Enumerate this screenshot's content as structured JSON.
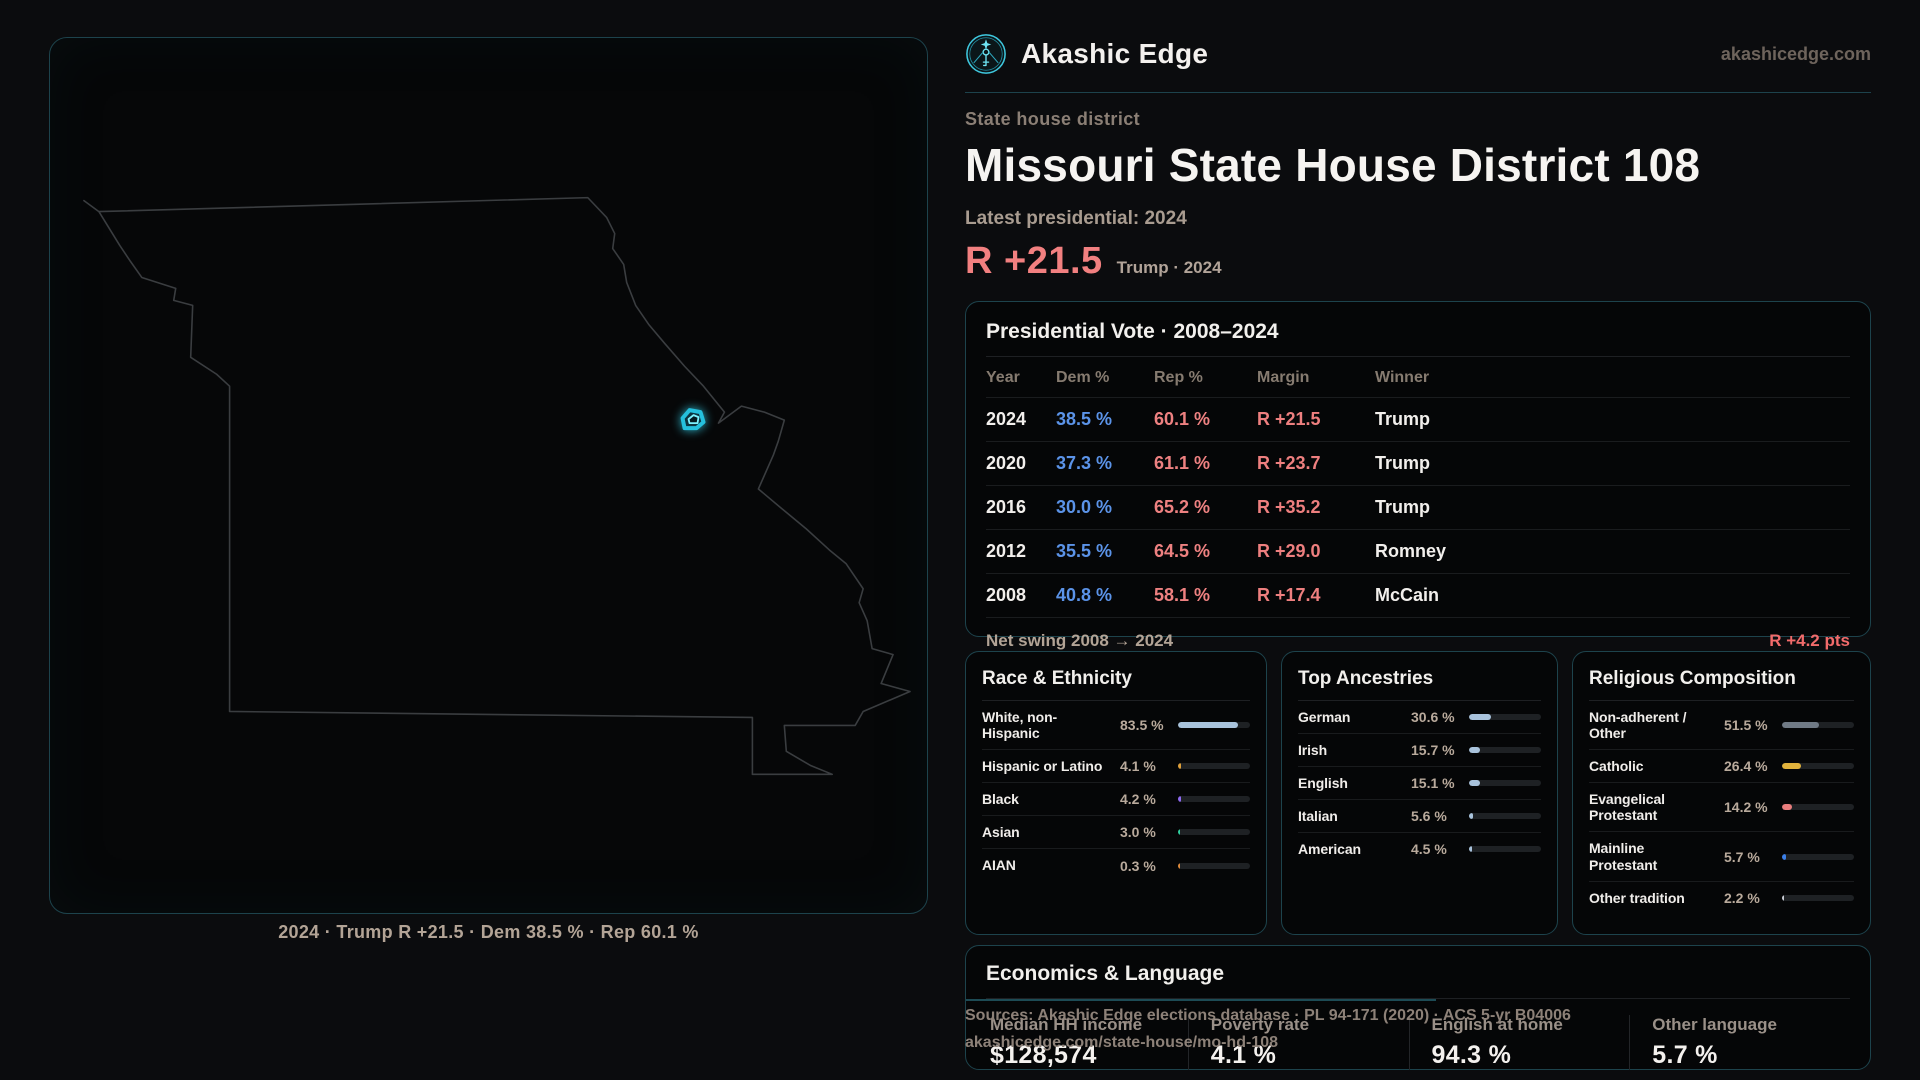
{
  "brand": {
    "name": "Akashic Edge",
    "domain": "akashicedge.com",
    "logo_icon": "akashic-emblem-icon",
    "accent_color": "#3fc9df"
  },
  "map": {
    "state": "Missouri",
    "highlight_color": "#35d5ef",
    "outline_color": "#3a3d40",
    "caption": "2024 · Trump R +21.5 · Dem 38.5 % · Rep 60.1 %"
  },
  "header": {
    "kicker": "State house district",
    "title": "Missouri State House District 108",
    "latest_label": "Latest presidential: 2024",
    "margin_value": "R +21.5",
    "margin_note": "Trump · 2024",
    "margin_color": "#f28080"
  },
  "vote_table": {
    "title": "Presidential Vote · 2008–2024",
    "columns": [
      "Year",
      "Dem %",
      "Rep %",
      "Margin",
      "Winner"
    ],
    "dem_color": "#5b93e8",
    "rep_color": "#ee8181",
    "rows": [
      {
        "year": "2024",
        "dem": "38.5 %",
        "rep": "60.1 %",
        "margin": "R +21.5",
        "winner": "Trump"
      },
      {
        "year": "2020",
        "dem": "37.3 %",
        "rep": "61.1 %",
        "margin": "R +23.7",
        "winner": "Trump"
      },
      {
        "year": "2016",
        "dem": "30.0 %",
        "rep": "65.2 %",
        "margin": "R +35.2",
        "winner": "Trump"
      },
      {
        "year": "2012",
        "dem": "35.5 %",
        "rep": "64.5 %",
        "margin": "R +29.0",
        "winner": "Romney"
      },
      {
        "year": "2008",
        "dem": "40.8 %",
        "rep": "58.1 %",
        "margin": "R +17.4",
        "winner": "McCain"
      }
    ],
    "footer_label": "Net swing 2008 → 2024",
    "footer_value": "R +4.2 pts"
  },
  "chart_data": [
    {
      "type": "table",
      "title": "Presidential Vote · 2008–2024",
      "columns": [
        "Year",
        "Dem %",
        "Rep %",
        "Margin",
        "Winner"
      ],
      "rows": [
        [
          2024,
          38.5,
          60.1,
          "R +21.5",
          "Trump"
        ],
        [
          2020,
          37.3,
          61.1,
          "R +23.7",
          "Trump"
        ],
        [
          2016,
          30.0,
          65.2,
          "R +35.2",
          "Trump"
        ],
        [
          2012,
          35.5,
          64.5,
          "R +29.0",
          "Romney"
        ],
        [
          2008,
          40.8,
          58.1,
          "R +17.4",
          "McCain"
        ]
      ]
    },
    {
      "type": "bar",
      "title": "Race & Ethnicity",
      "categories": [
        "White, non-Hispanic",
        "Hispanic or Latino",
        "Black",
        "Asian",
        "AIAN"
      ],
      "values": [
        83.5,
        4.1,
        4.2,
        3.0,
        0.3
      ],
      "xlim": [
        0,
        100
      ]
    },
    {
      "type": "bar",
      "title": "Top Ancestries",
      "categories": [
        "German",
        "Irish",
        "English",
        "Italian",
        "American"
      ],
      "values": [
        30.6,
        15.7,
        15.1,
        5.6,
        4.5
      ],
      "xlim": [
        0,
        100
      ]
    },
    {
      "type": "bar",
      "title": "Religious Composition",
      "categories": [
        "Non-adherent / Other",
        "Catholic",
        "Evangelical Protestant",
        "Mainline Protestant",
        "Other tradition"
      ],
      "values": [
        51.5,
        26.4,
        14.2,
        5.7,
        2.2
      ],
      "xlim": [
        0,
        100
      ]
    }
  ],
  "demographics": [
    {
      "title": "Race & Ethnicity",
      "rows": [
        {
          "label": "White, non-Hispanic",
          "value": "83.5 %",
          "pct": 83.5,
          "color": "#a9c3dc"
        },
        {
          "label": "Hispanic or Latino",
          "value": "4.1 %",
          "pct": 4.1,
          "color": "#dfa03a"
        },
        {
          "label": "Black",
          "value": "4.2 %",
          "pct": 4.2,
          "color": "#8f6af2"
        },
        {
          "label": "Asian",
          "value": "3.0 %",
          "pct": 3.0,
          "color": "#2fcf9f"
        },
        {
          "label": "AIAN",
          "value": "0.3 %",
          "pct": 0.3,
          "color": "#df8a3a"
        }
      ]
    },
    {
      "title": "Top Ancestries",
      "rows": [
        {
          "label": "German",
          "value": "30.6 %",
          "pct": 30.6,
          "color": "#a9c3dc"
        },
        {
          "label": "Irish",
          "value": "15.7 %",
          "pct": 15.7,
          "color": "#a9c3dc"
        },
        {
          "label": "English",
          "value": "15.1 %",
          "pct": 15.1,
          "color": "#a9c3dc"
        },
        {
          "label": "Italian",
          "value": "5.6 %",
          "pct": 5.6,
          "color": "#a9c3dc"
        },
        {
          "label": "American",
          "value": "4.5 %",
          "pct": 4.5,
          "color": "#a9c3dc"
        }
      ]
    },
    {
      "title": "Religious Composition",
      "rows": [
        {
          "label": "Non-adherent / Other",
          "value": "51.5 %",
          "pct": 51.5,
          "color": "#707a85"
        },
        {
          "label": "Catholic",
          "value": "26.4 %",
          "pct": 26.4,
          "color": "#e2b33c"
        },
        {
          "label": "Evangelical Protestant",
          "value": "14.2 %",
          "pct": 14.2,
          "color": "#e97d7d"
        },
        {
          "label": "Mainline Protestant",
          "value": "5.7 %",
          "pct": 5.7,
          "color": "#3b7fe8"
        },
        {
          "label": "Other tradition",
          "value": "2.2 %",
          "pct": 2.2,
          "color": "#c8ccd4"
        }
      ]
    }
  ],
  "economics": {
    "title": "Economics & Language",
    "stats": [
      {
        "label": "Median HH income",
        "value": "$128,574"
      },
      {
        "label": "Poverty rate",
        "value": "4.1 %"
      },
      {
        "label": "English at home",
        "value": "94.3 %"
      },
      {
        "label": "Other language",
        "value": "5.7 %"
      }
    ]
  },
  "sources": {
    "line1": "Sources: Akashic Edge elections database · PL 94-171 (2020) · ACS 5-yr B04006",
    "line2": "akashicedge.com/state-house/mo-hd-108"
  }
}
